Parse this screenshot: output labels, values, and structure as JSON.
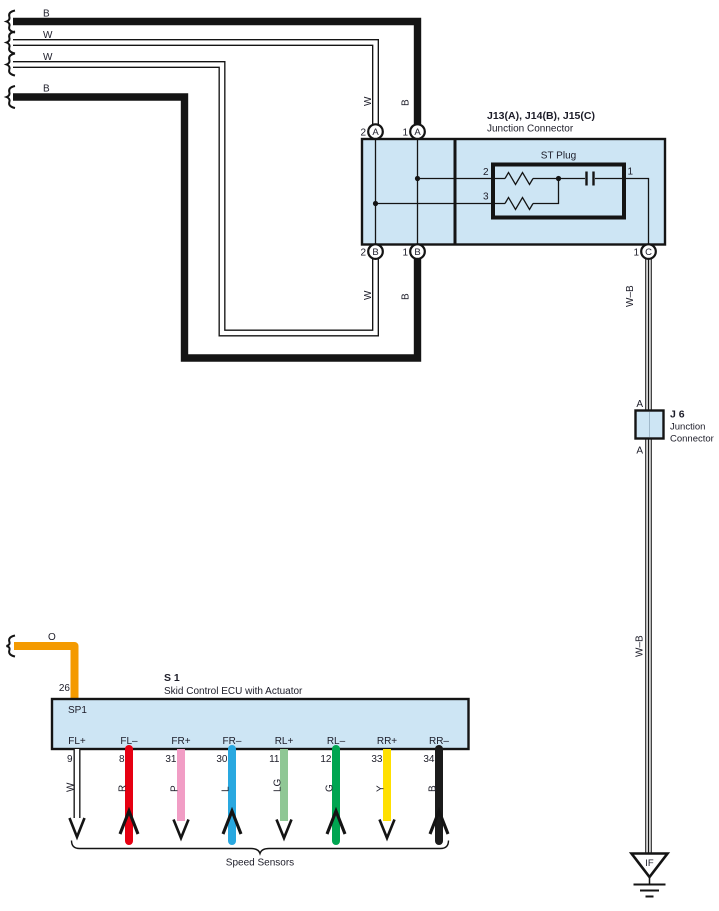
{
  "palette": {
    "line": "#141414",
    "text": "#1c1c28",
    "box_fill": "#cde5f4",
    "wire_white": "#ffffff"
  },
  "harness": {
    "feeds": [
      {
        "label": "B"
      },
      {
        "label": "W"
      },
      {
        "label": "W"
      },
      {
        "label": "B"
      }
    ],
    "drop_labels": {
      "w": "W",
      "b": "B"
    }
  },
  "junction_connector": {
    "title": "J13(A), J14(B), J15(C)",
    "subtitle": "Junction Connector",
    "pins_top": [
      {
        "num": "2",
        "letter": "A"
      },
      {
        "num": "1",
        "letter": "A"
      }
    ],
    "pins_bottom": [
      {
        "num": "2",
        "letter": "B"
      },
      {
        "num": "1",
        "letter": "B"
      },
      {
        "num": "1",
        "letter": "C"
      }
    ],
    "st_plug": {
      "title": "ST Plug",
      "pin_2": "2",
      "pin_3": "3",
      "pin_1": "1"
    }
  },
  "wb_wire": {
    "label": "W–B"
  },
  "j6": {
    "name": "J 6",
    "type_line1": "Junction",
    "type_line2": "Connector",
    "pin": "A"
  },
  "ground": {
    "code": "IF"
  },
  "ecu": {
    "code": "S 1",
    "desc": "Skid Control ECU with Actuator",
    "splice": "SP1",
    "supply_pin": "26",
    "supply_color_code": "O",
    "supply_color": "#f49a00"
  },
  "sensors": [
    {
      "pin": "9",
      "label": "FL+",
      "code": "W",
      "color": "#ffffff"
    },
    {
      "pin": "8",
      "label": "FL–",
      "code": "R",
      "color": "#e60012"
    },
    {
      "pin": "31",
      "label": "FR+",
      "code": "P",
      "color": "#f19dc5"
    },
    {
      "pin": "30",
      "label": "FR–",
      "code": "L",
      "color": "#29a8e0"
    },
    {
      "pin": "11",
      "label": "RL+",
      "code": "LG",
      "color": "#8fc795"
    },
    {
      "pin": "12",
      "label": "RL–",
      "code": "G",
      "color": "#00a551"
    },
    {
      "pin": "33",
      "label": "RR+",
      "code": "Y",
      "color": "#ffe000"
    },
    {
      "pin": "34",
      "label": "RR–",
      "code": "B",
      "color": "#1b1b1b"
    }
  ],
  "footer": {
    "label": "Speed Sensors"
  }
}
